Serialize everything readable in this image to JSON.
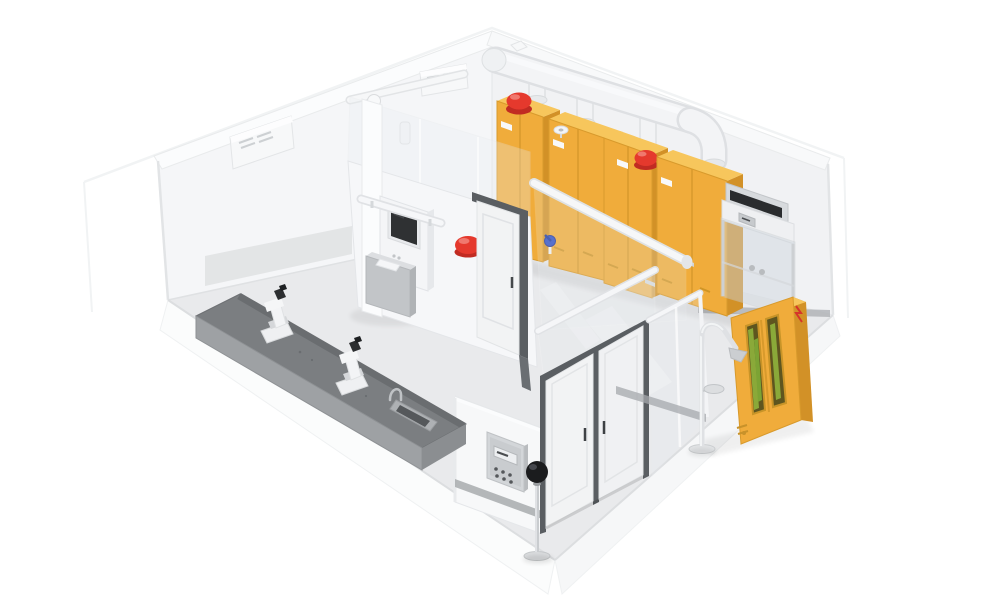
{
  "scene": {
    "type": "isometric-laboratory-cutaway-render",
    "counts": {
      "safety_cabinets": 4,
      "alarm_beacons": 4,
      "microscopes": 2,
      "ac_units": 2,
      "doors_single": 1,
      "doors_double": 1
    },
    "equipment": [
      {
        "name": "wall-ac-unit-1"
      },
      {
        "name": "wall-ac-unit-2"
      },
      {
        "name": "ceiling-pipe"
      },
      {
        "name": "sprinkler-head"
      },
      {
        "name": "exhaust-duct"
      },
      {
        "name": "duct-branch-1"
      },
      {
        "name": "duct-branch-2"
      },
      {
        "name": "duct-branch-3"
      },
      {
        "name": "duct-elbow"
      },
      {
        "name": "safety-cabinet-1"
      },
      {
        "name": "safety-cabinet-2"
      },
      {
        "name": "safety-cabinet-3"
      },
      {
        "name": "safety-cabinet-4"
      },
      {
        "name": "alarm-beacon-wall"
      },
      {
        "name": "alarm-beacon-partition"
      },
      {
        "name": "alarm-beacon-cabinet-1"
      },
      {
        "name": "alarm-beacon-cabinet-3"
      },
      {
        "name": "funnel-vent"
      },
      {
        "name": "blue-valve"
      },
      {
        "name": "fume-hood"
      },
      {
        "name": "corridor-glass-wall"
      },
      {
        "name": "partition-wall"
      },
      {
        "name": "kiosk-terminal"
      },
      {
        "name": "terminal-pedestal"
      },
      {
        "name": "interior-door"
      },
      {
        "name": "front-wall"
      },
      {
        "name": "control-panel"
      },
      {
        "name": "black-globe-monitor"
      },
      {
        "name": "double-door"
      },
      {
        "name": "glazed-wall-section"
      },
      {
        "name": "emergency-shower"
      },
      {
        "name": "eyewash-bowl"
      },
      {
        "name": "gas-cylinder-cabinet"
      },
      {
        "name": "workbench"
      },
      {
        "name": "microscope-1"
      },
      {
        "name": "microscope-2"
      },
      {
        "name": "sink"
      },
      {
        "name": "faucet"
      }
    ]
  },
  "palette": {
    "background": "#FFFFFF",
    "wall": "#F5F6F8",
    "wall_shaded": "#F1F2F4",
    "wall_edge": "#E4E6E9",
    "wall_beam": "#FBFCFD",
    "floor": "#E9EAEC",
    "platform": "#FBFCFC",
    "platform_side": "#F6F7F8",
    "baseboard": "#A5A8AC",
    "glass": "#E7EBEE",
    "duct": "#F3F4F6",
    "duct_shade": "#DEE0E3",
    "cabinet_front": "#F0AC3B",
    "cabinet_side": "#D29127",
    "cabinet_top": "#F7C65C",
    "cabinet_line": "#D89A2C",
    "alarm_red": "#E5392D",
    "alarm_red_dark": "#C12B22",
    "alarm_gloss": "#F0786E",
    "door_leaf": "#F2F3F4",
    "door_leaf_shaded": "#F0F1F3",
    "door_frame": "#5A5E62",
    "bench_top": "#7B7E81",
    "bench_front": "#9EA1A4",
    "bench_side": "#8B8E91",
    "bench_lip": "#6A6D70",
    "metal": "#C9CCCF",
    "screen": "#2F3133",
    "panel_body": "#D3D6D9",
    "sphere_black": "#1B1C1E",
    "valve_blue": "#2E4FC4",
    "cylinder_green": "#8FB23C",
    "gas_window": "#5E551F",
    "machine_body": "#F4F5F7",
    "pedestal": "#C2C5C8",
    "ac_body": "#F7F8F9",
    "hood_dark": "#2A2C2E"
  }
}
